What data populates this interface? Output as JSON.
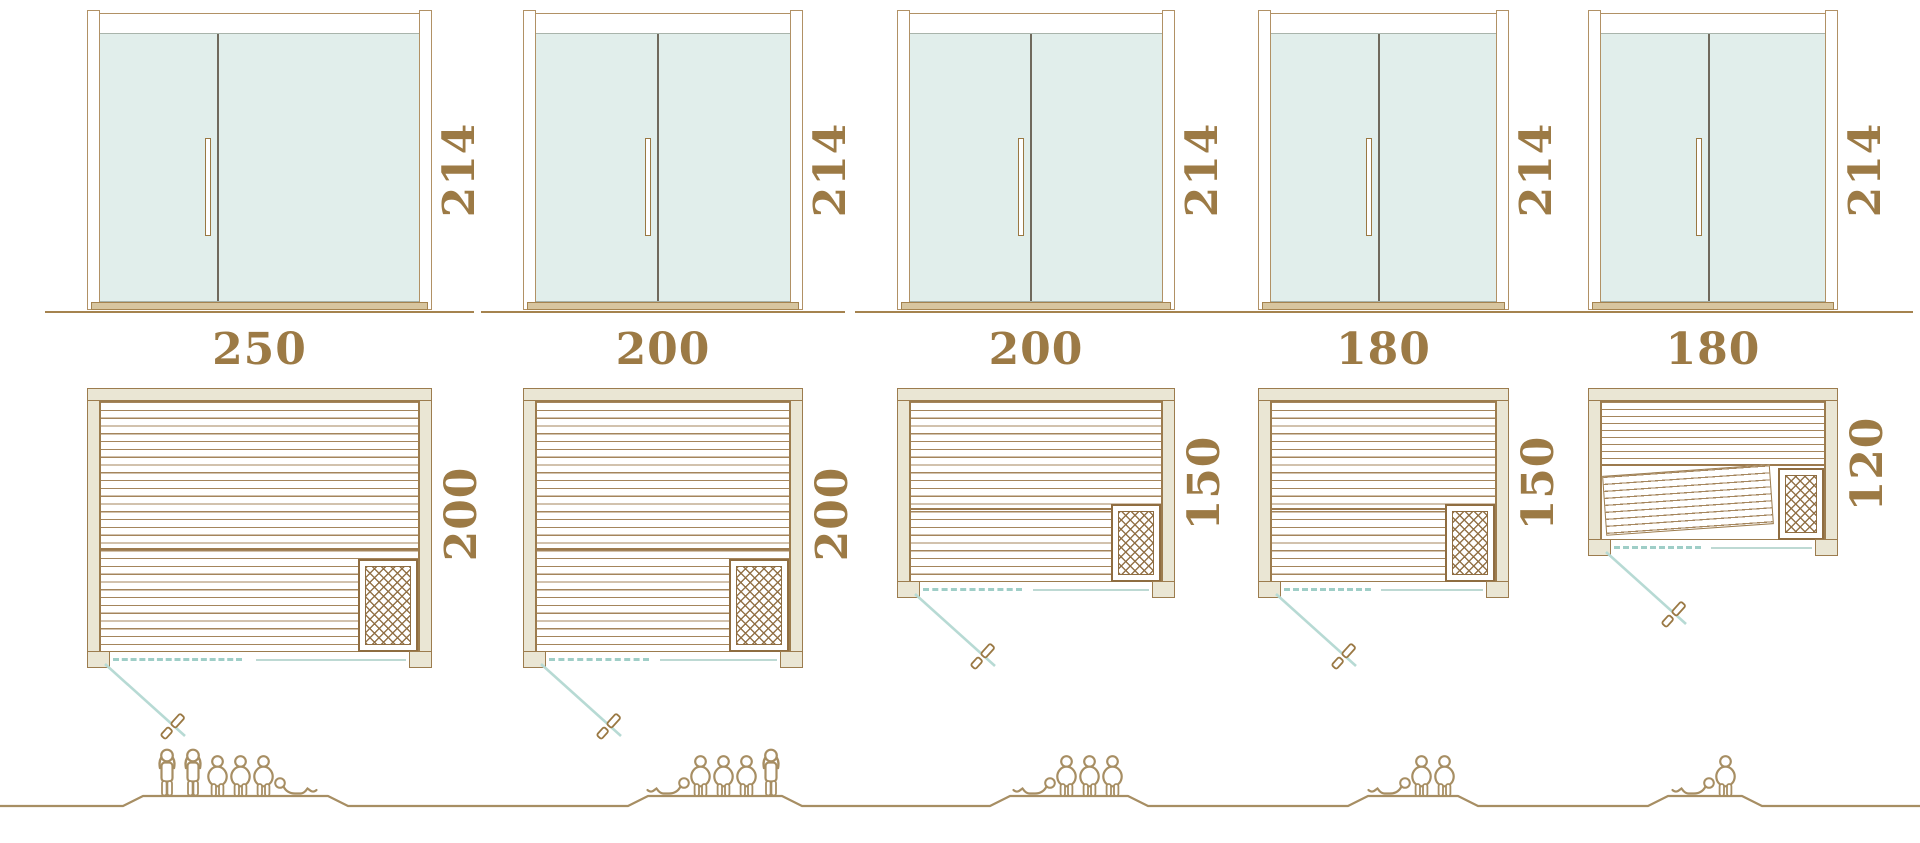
{
  "diagram": {
    "kind": "sauna-size-comparison"
  },
  "colors": {
    "dimension_text": "#9c7a45",
    "frame_outline": "#b19165",
    "wall_fill": "#eae6d4",
    "wall_outline": "#9c7c4e",
    "glass_fill": "#e1eeeb",
    "heater_outline": "#8f6d41",
    "swing_teal": "#b7dad4",
    "opening_dash_teal": "#9fcec7",
    "people_ground": "#a78e63"
  },
  "units": [
    {
      "door": {
        "height_label": "214"
      },
      "plan": {
        "width_label": "250",
        "depth_label": "200"
      },
      "capacity": {
        "total": 6,
        "figures": [
          "standing",
          "standing",
          "seated",
          "seated",
          "seated",
          "lying-right"
        ]
      }
    },
    {
      "door": {
        "height_label": "214"
      },
      "plan": {
        "width_label": "200",
        "depth_label": "200"
      },
      "capacity": {
        "total": 5,
        "figures": [
          "lying-left",
          "seated",
          "seated",
          "seated",
          "standing"
        ]
      }
    },
    {
      "door": {
        "height_label": "214"
      },
      "plan": {
        "width_label": "200",
        "depth_label": "150"
      },
      "capacity": {
        "total": 4,
        "figures": [
          "lying-left",
          "seated",
          "seated",
          "seated"
        ]
      }
    },
    {
      "door": {
        "height_label": "214"
      },
      "plan": {
        "width_label": "180",
        "depth_label": "150"
      },
      "capacity": {
        "total": 3,
        "figures": [
          "lying-left",
          "seated",
          "seated"
        ]
      }
    },
    {
      "door": {
        "height_label": "214"
      },
      "plan": {
        "width_label": "180",
        "depth_label": "120"
      },
      "capacity": {
        "total": 2,
        "figures": [
          "lying-left",
          "seated"
        ]
      }
    }
  ]
}
